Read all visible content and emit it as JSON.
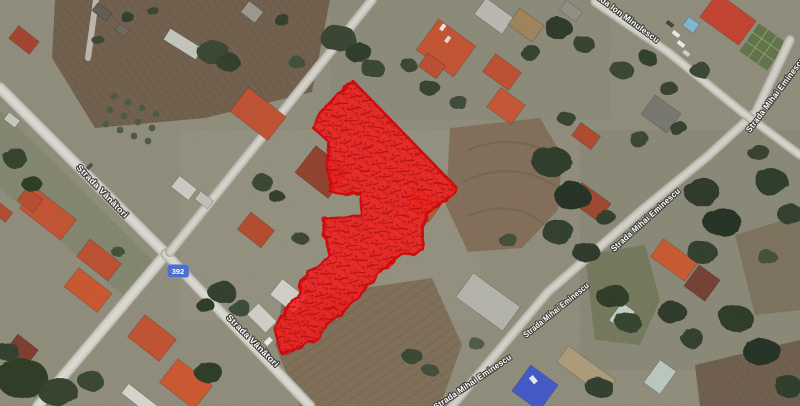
{
  "map": {
    "view": "satellite",
    "route_shield": {
      "number": "392",
      "background": "#4d70cf",
      "text_color": "#ffffff"
    },
    "street_labels": [
      {
        "id": "strada-vanatori-upper",
        "text": "Strada Vânători"
      },
      {
        "id": "strada-vanatori-lower",
        "text": "Strada Vânători"
      },
      {
        "id": "strada-mihai-eminescu-south",
        "text": "Strada Mihai Eminescu"
      },
      {
        "id": "strada-mihai-eminescu-mid",
        "text": "Strada Mihai Eminescu"
      },
      {
        "id": "strada-mihai-eminescu-north",
        "text": "Strada Mihai Eminescu"
      },
      {
        "id": "strada-mihai-eminescu-corner",
        "text": "Strada Mihai Eminescu"
      },
      {
        "id": "strada-ion-minulescu",
        "text": "Strada Ion Minulescu"
      }
    ],
    "highlight": {
      "label": "selected-parcel",
      "color": "#f01d1d"
    },
    "palette": {
      "ground": "#8c8977",
      "road": "#d6d4cb",
      "field_brown": "#6d5a47",
      "tree_green": "#2c3925",
      "roof_orange": "#c14d2b",
      "roof_blue": "#3b53c6"
    }
  }
}
